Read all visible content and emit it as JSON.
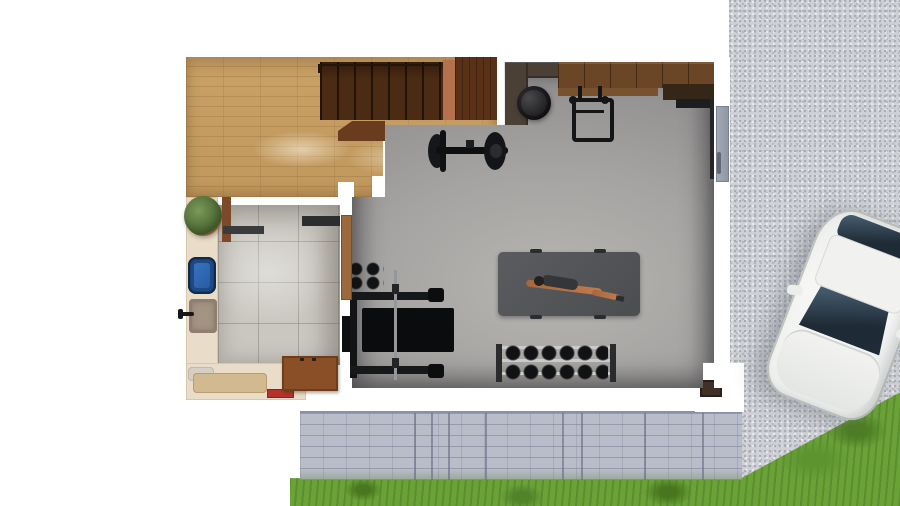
{
  "meta": {
    "type": "3d-floor-plan-rendering",
    "subject": "Top-down architectural rendering of a basement home gym, utility room, hardwood hall with staircase, gravel driveway with parked white car, and lawn with concrete block retaining wall",
    "canvas": {
      "width": 900,
      "height": 506
    },
    "visible_text": ""
  },
  "objects": {
    "hall": {
      "label": "Hardwood hallway with staircase"
    },
    "staircase": {
      "label": "Wooden staircase"
    },
    "landing": {
      "label": "Stair landing"
    },
    "gym": {
      "label": "Home gym - concrete floor"
    },
    "utility": {
      "label": "Utility room with tiled floor"
    },
    "driveway": {
      "label": "Gravel driveway"
    },
    "lawn": {
      "label": "Lawn"
    },
    "retaining_wall": {
      "label": "Concrete block retaining wall"
    },
    "car": {
      "label": "White car parked on driveway"
    },
    "exercise_mat": {
      "label": "Exercise mat with person stretching"
    },
    "person": {
      "label": "Person lying on mat, arms outstretched"
    },
    "dumbbell_rack": {
      "label": "Dumbbell rack"
    },
    "bench_press": {
      "label": "Bench press station with barbell"
    },
    "small_dumbbells": {
      "label": "Pair of small dumbbells"
    },
    "exercise_bike": {
      "label": "Exercise bike"
    },
    "exercise_ball": {
      "label": "Dark exercise ball"
    },
    "wall_rack": {
      "label": "Wall-mounted folding rack"
    },
    "counter": {
      "label": "Dark corner counter"
    },
    "cabinets": {
      "label": "Wooden wall cabinets"
    },
    "corner_desk": {
      "label": "Corner desk shelf"
    },
    "door": {
      "label": "Side entry door"
    },
    "pillar": {
      "label": "Exterior pillar"
    },
    "plant": {
      "label": "Potted plant"
    },
    "basin": {
      "label": "Blue basin"
    },
    "sink": {
      "label": "Wash sink with faucet"
    },
    "shelves": {
      "label": "Wall shelves"
    },
    "towels": {
      "label": "Folded towels on counter"
    },
    "red_box": {
      "label": "Red box on counter"
    },
    "wood_cabinet": {
      "label": "Wooden cabinet"
    }
  },
  "palette": {
    "background": "#ffffff",
    "wood_light": "#c79e63",
    "wood_dark": "#5a3117",
    "stair_brown": "#4c2b15",
    "concrete_floor": "#a5a3a1",
    "tile_gray": "#cac7c0",
    "counter_cream": "#e9dcc8",
    "basin_blue": "#2a5da6",
    "cabinet_brown": "#6a4526",
    "gravel_gray": "#cfd1d6",
    "block_wall": "#b9bdca",
    "grass_green": "#6aa238",
    "equipment_black": "#141517",
    "car_white": "#f4f5f3",
    "skin_tone": "#b5744a",
    "red_accent": "#b5332b",
    "door_gray": "#99a0ab"
  }
}
